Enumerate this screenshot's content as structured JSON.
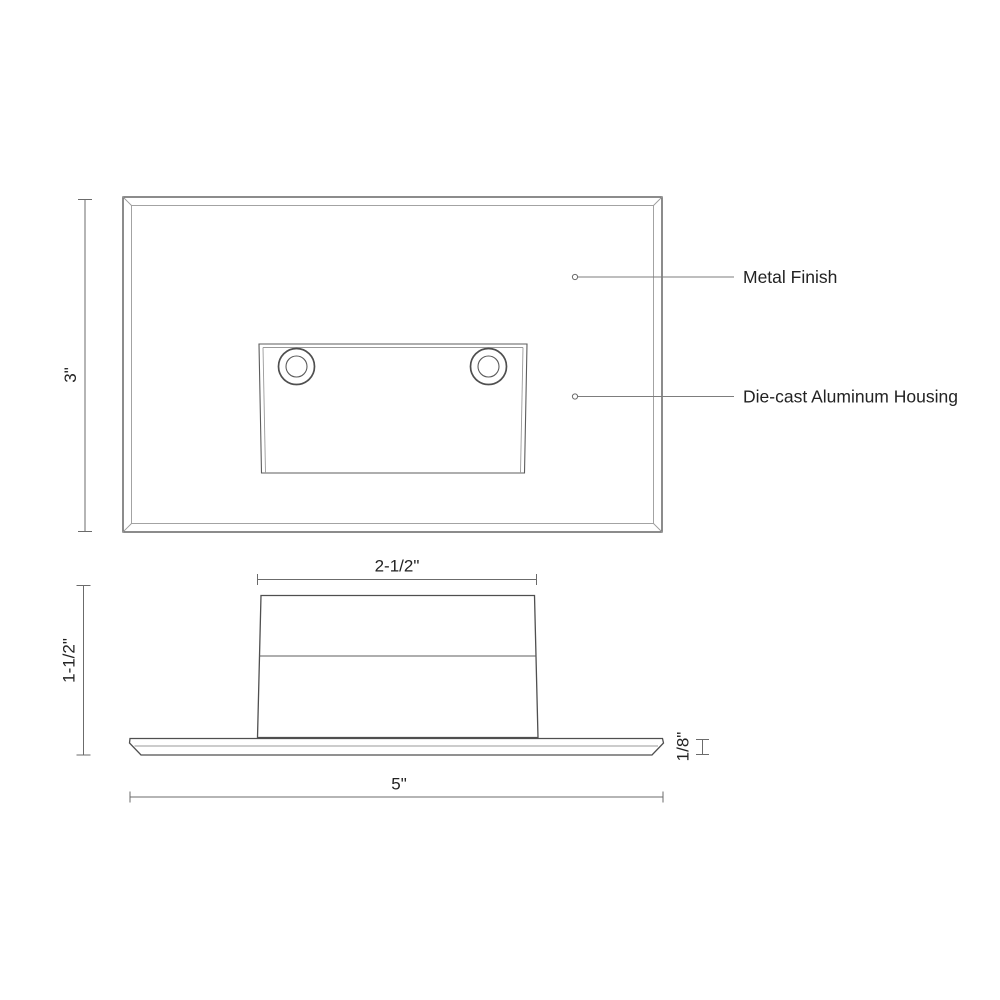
{
  "drawing": {
    "type": "technical-dimension-drawing",
    "annotations": {
      "metal_finish": "Metal Finish",
      "housing": "Die-cast Aluminum Housing"
    },
    "dimensions": {
      "front_height": "3\"",
      "housing_width": "2-1/2\"",
      "side_height": "1-1/2\"",
      "plate_thickness": "1/8\"",
      "plate_width": "5\""
    },
    "colors": {
      "background": "#ffffff",
      "main_line": "#4f4f4f",
      "light_line": "#9a9a9a",
      "dimension_line": "#6b6b6b",
      "text": "#232323"
    }
  }
}
